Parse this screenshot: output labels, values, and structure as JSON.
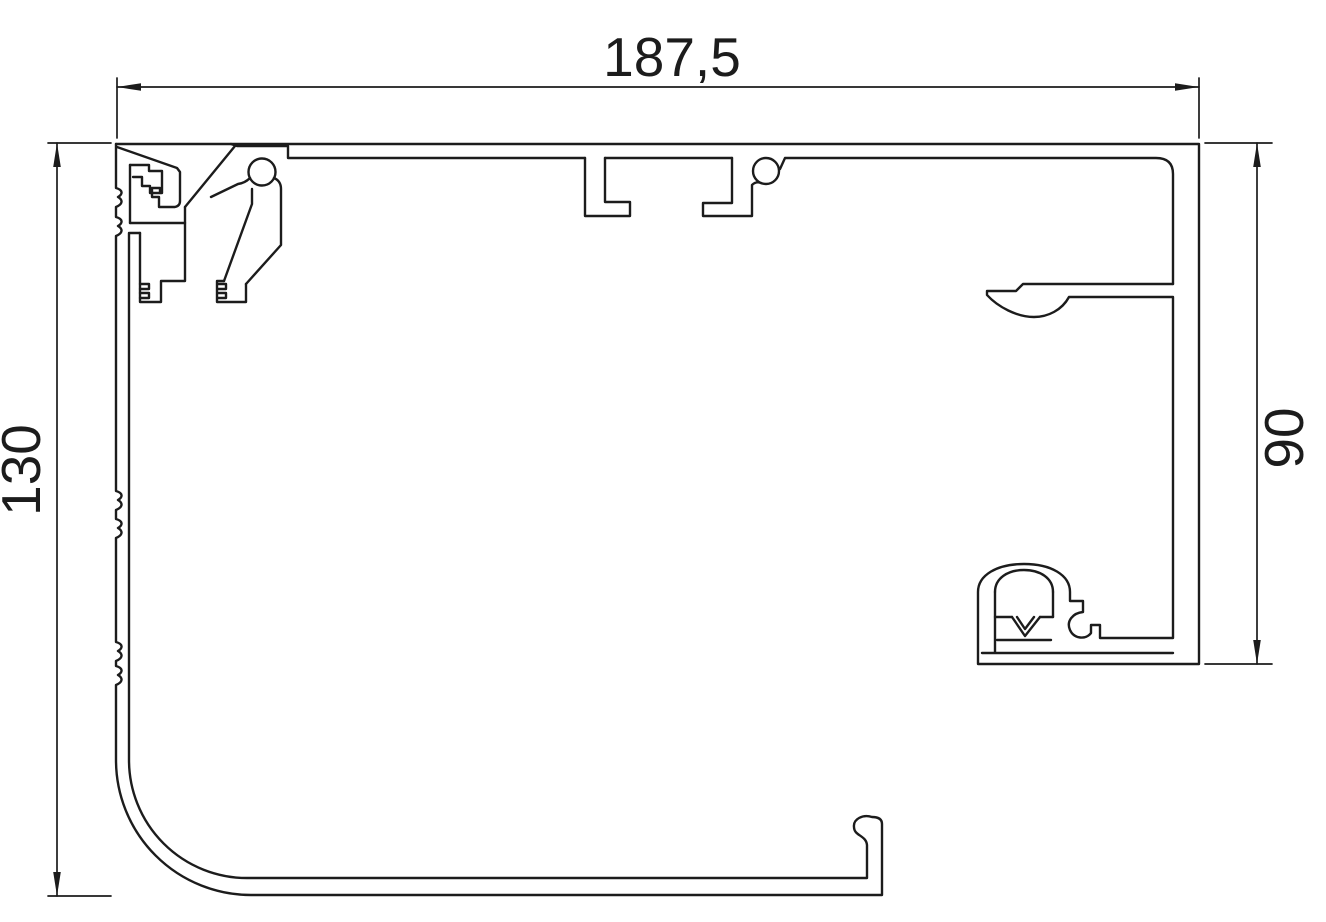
{
  "drawing": {
    "type": "technical-cross-section",
    "subject": "extruded aluminium profile cross-section (roller shutter box / frame profile)",
    "background_color": "#ffffff",
    "line_color": "#1c1c1c",
    "dimensions": {
      "width_top": {
        "label": "187,5",
        "value": 187.5,
        "orientation": "horizontal"
      },
      "height_left": {
        "label": "130",
        "value": 130,
        "orientation": "vertical",
        "text_rotation_deg": -90
      },
      "height_right": {
        "label": "90",
        "value": 90,
        "orientation": "vertical",
        "text_rotation_deg": -90
      }
    }
  }
}
